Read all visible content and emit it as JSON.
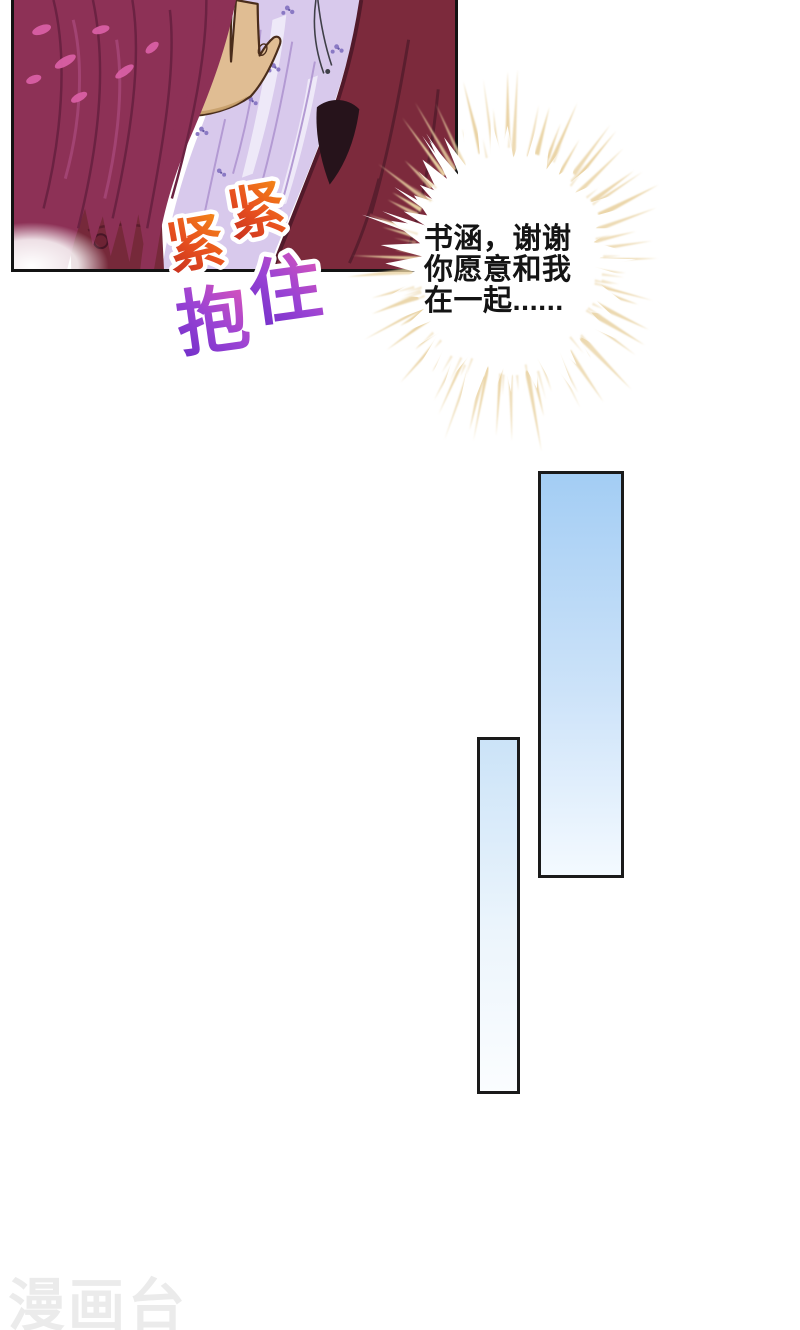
{
  "page": {
    "width": 800,
    "height": 1330,
    "background": "#ffffff"
  },
  "panel": {
    "border_color": "#131313",
    "art": {
      "hair_color": "#8d3156",
      "hair_line": "#6b2242",
      "hair_highlight": "#d95fa4",
      "skin": "#e0bd93",
      "skin_shadow": "#c79e6a",
      "skin_outline": "#4a2d1b",
      "blouse": "#d8c9ec",
      "blouse_fold": "#b39ad3",
      "blouse_highlight": "#f1ecf9",
      "floral": "#8a79c4",
      "jacket": "#7c2a3c",
      "jacket_fold": "#5a1e2e",
      "jacket_shadow": "#26131b",
      "arm": "#76293a"
    }
  },
  "sfx_tight": {
    "chars": [
      "紧",
      "紧"
    ],
    "gradient": [
      "#c22a1e",
      "#e8511f",
      "#f58f16"
    ],
    "outline": "#ffffff"
  },
  "sfx_hug": {
    "chars": [
      "抱",
      "住"
    ],
    "gradient": [
      "#6c2cc8",
      "#9a43d4",
      "#e055b8"
    ],
    "outline": "#ffffff"
  },
  "speech": {
    "lines": [
      "书涵，谢谢",
      "你愿意和我",
      "在一起......"
    ],
    "text_color": "#141414",
    "ray_color": "#e9d2a2",
    "core_color": "#ffffff"
  },
  "decor_bars": [
    {
      "top_color": "#a3cdf4",
      "bottom_color": "#f4faff",
      "border": "#1a1a1a"
    },
    {
      "top_color": "#cbe3f8",
      "bottom_color": "#fbfdff",
      "border": "#1a1a1a"
    }
  ],
  "watermark": {
    "text": "漫画台",
    "color": "#ebebeb"
  }
}
